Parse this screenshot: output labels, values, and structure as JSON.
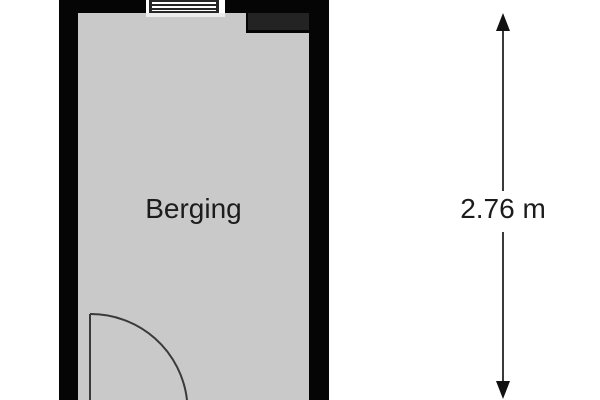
{
  "floorplan": {
    "room": {
      "label": "Berging"
    },
    "dimension": {
      "label": "2.76 m"
    },
    "colors": {
      "background": "#ffffff",
      "wall": "#050505",
      "wall_block": "#232323",
      "interior": "#c9c9c9",
      "window_line": "#262626",
      "sill": "#ececec",
      "line": "#3a3a3a",
      "arrowhead": "#111111",
      "text": "#1c1c1c"
    }
  }
}
